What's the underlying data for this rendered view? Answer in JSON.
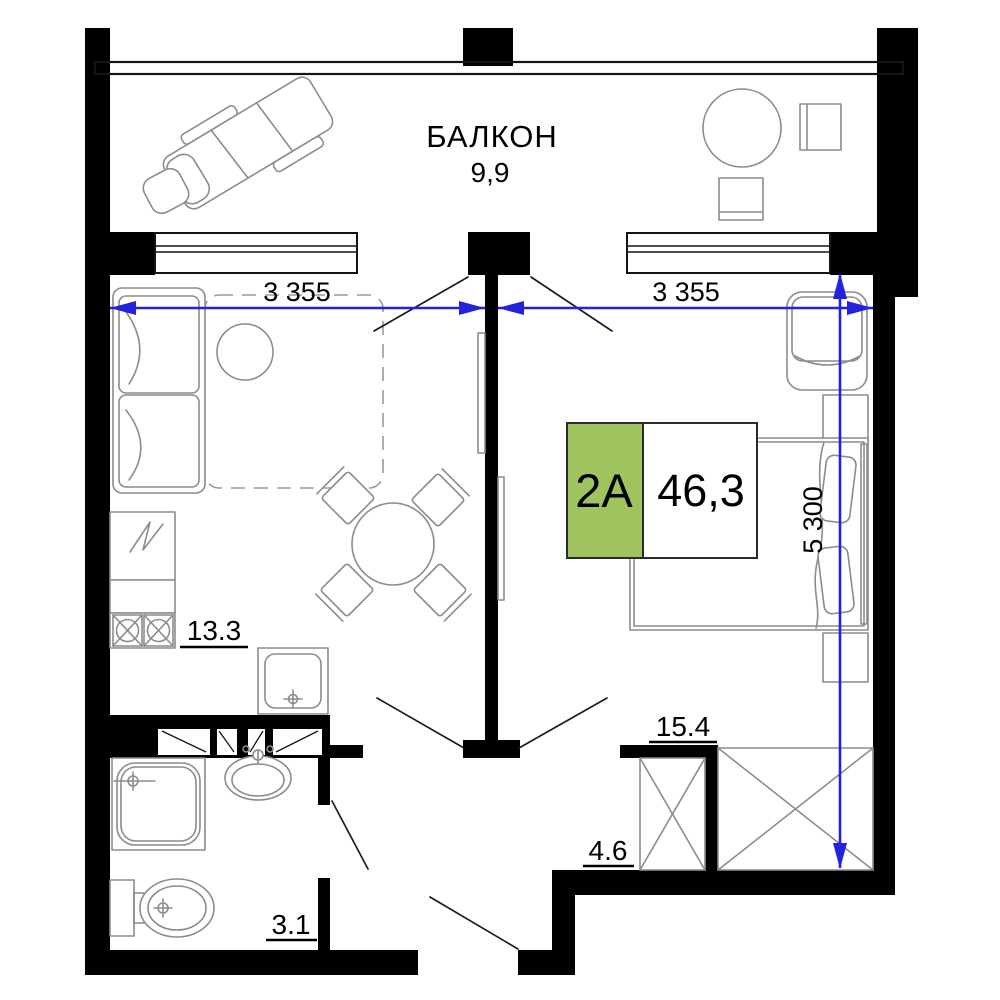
{
  "colors": {
    "wall_black": "#000000",
    "dimension_blue": "#2323dd",
    "accent_green": "#9ec35f",
    "furniture_gray": "#8c8c8c"
  },
  "unit": {
    "code": "2A",
    "area_total": "46,3"
  },
  "balcony": {
    "name": "БАЛКОН",
    "area": "9,9"
  },
  "rooms": {
    "kitchen_living": {
      "area": "13.3"
    },
    "bedroom": {
      "area": "15.4"
    },
    "hallway": {
      "area": "4.6"
    },
    "bathroom": {
      "area": "3.1"
    }
  },
  "dimensions": {
    "width_left": "3 355",
    "width_right": "3 355",
    "depth_right": "5 300"
  },
  "symbols": [
    "chaise-lounge-icon",
    "balcony-table-icon",
    "balcony-chair-icon",
    "sofa-icon",
    "coffee-table-icon",
    "dining-table-icon",
    "dining-chair-icon",
    "fridge-icon",
    "stove-icon",
    "kitchen-sink-icon",
    "shower-icon",
    "washbasin-icon",
    "toilet-icon",
    "bed-icon",
    "armchair-icon",
    "nightstand-icon",
    "wardrobe-icon",
    "door-swing-icon",
    "dimension-arrow-icon"
  ]
}
